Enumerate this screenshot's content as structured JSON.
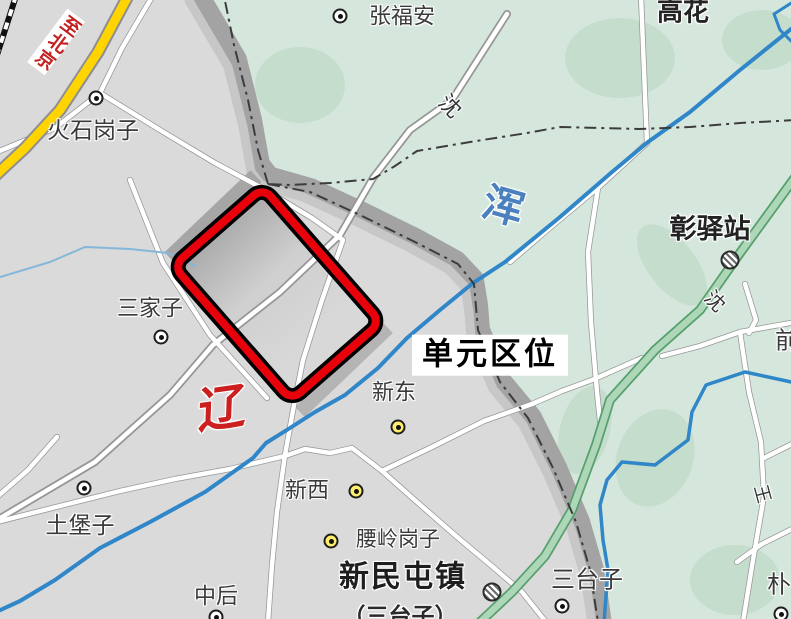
{
  "map": {
    "annotation": "单元区位",
    "colors": {
      "land": "#dadada",
      "green_area": "#d5e7dc",
      "green_patch": "#c5ddcd",
      "urban_band": "#a3a3a3",
      "urban_band_inner": "#c7c7c7",
      "water": "#2f86c8",
      "stream": "#85b7d9",
      "road_fill": "#ffffff",
      "road_casing": "#969696",
      "yellow_road": "#ffd400",
      "green_road": "#aed7ba",
      "green_road_casing": "#57a06c",
      "highlight_box": "#e8000b",
      "boundary_line": "#3c3c3c",
      "red_text": "#c32222",
      "river_text": "#4b80bf"
    },
    "labels": [
      {
        "name": "label-to-beijing",
        "text": "至北京",
        "x": 56,
        "y": 42,
        "size": 19,
        "weight": 700,
        "color": "#c32222",
        "rotate": 37,
        "bg": "#ffffff",
        "vertical": true,
        "pad": "2px 1px"
      },
      {
        "name": "label-huoshigangzi",
        "text": "火石岗子",
        "x": 93,
        "y": 130,
        "size": 23,
        "weight": 400,
        "color": "#3a3a3a",
        "rotate": 0
      },
      {
        "name": "label-zhangfuan",
        "text": "张福安",
        "x": 402,
        "y": 16,
        "size": 22,
        "weight": 400,
        "color": "#3a3a3a",
        "rotate": 0
      },
      {
        "name": "label-gaohua",
        "text": "高花",
        "x": 683,
        "y": 12,
        "size": 26,
        "weight": 700,
        "color": "#242424",
        "rotate": 0
      },
      {
        "name": "label-shen-road-north",
        "text": "沈",
        "x": 450,
        "y": 106,
        "size": 22,
        "weight": 400,
        "color": "#333333",
        "rotate": 45
      },
      {
        "name": "label-hun-river",
        "text": "浑",
        "x": 503,
        "y": 207,
        "size": 41,
        "weight": 700,
        "color": "#4b80bf",
        "rotate": 16
      },
      {
        "name": "label-zhangyizhan",
        "text": "彰驿站",
        "x": 710,
        "y": 229,
        "size": 27,
        "weight": 700,
        "color": "#222222",
        "rotate": 0
      },
      {
        "name": "label-sanjiazi",
        "text": "三家子",
        "x": 150,
        "y": 308,
        "size": 22,
        "weight": 400,
        "color": "#3a3a3a",
        "rotate": 0
      },
      {
        "name": "label-unit-location",
        "text": "单元区位",
        "x": 490,
        "y": 355,
        "size": 31,
        "weight": 700,
        "color": "#000000",
        "rotate": 0,
        "bg": "#ffffff",
        "pad": "4px 10px",
        "ls": 3
      },
      {
        "name": "label-liao-river",
        "text": "辽",
        "x": 222,
        "y": 410,
        "size": 48,
        "weight": 700,
        "color": "#cc1f1f",
        "rotate": -8,
        "skew": -10
      },
      {
        "name": "label-xindong",
        "text": "新东",
        "x": 394,
        "y": 392,
        "size": 22,
        "weight": 400,
        "color": "#3a3a3a",
        "rotate": 0
      },
      {
        "name": "label-xinxi",
        "text": "新西",
        "x": 307,
        "y": 490,
        "size": 22,
        "weight": 400,
        "color": "#3a3a3a",
        "rotate": 0
      },
      {
        "name": "label-yaolinggangzi",
        "text": "腰岭岗子",
        "x": 398,
        "y": 540,
        "size": 21,
        "weight": 400,
        "color": "#3a3a3a",
        "rotate": 0
      },
      {
        "name": "label-xinmintunzhen",
        "text": "新民屯镇",
        "x": 403,
        "y": 577,
        "size": 30,
        "weight": 700,
        "color": "#1e1e1e",
        "rotate": 0,
        "ls": 2
      },
      {
        "name": "label-santaizi-paren",
        "text": "（三台子）",
        "x": 400,
        "y": 616,
        "size": 23,
        "weight": 700,
        "color": "#2a2a2a",
        "rotate": 0
      },
      {
        "name": "label-zhonghou",
        "text": "中后",
        "x": 216,
        "y": 596,
        "size": 22,
        "weight": 400,
        "color": "#3a3a3a",
        "rotate": 0
      },
      {
        "name": "label-tubaozi",
        "text": "土堡子",
        "x": 80,
        "y": 525,
        "size": 23,
        "weight": 400,
        "color": "#3a3a3a",
        "rotate": 0
      },
      {
        "name": "label-santaizi",
        "text": "三台子",
        "x": 587,
        "y": 580,
        "size": 24,
        "weight": 400,
        "color": "#3a3a3a",
        "rotate": 0
      },
      {
        "name": "label-pu",
        "text": "朴",
        "x": 779,
        "y": 585,
        "size": 24,
        "weight": 400,
        "color": "#3a3a3a",
        "rotate": 0
      },
      {
        "name": "label-qian",
        "text": "前",
        "x": 787,
        "y": 341,
        "size": 24,
        "weight": 400,
        "color": "#3a3a3a",
        "rotate": 0
      },
      {
        "name": "label-shen-road-east",
        "text": "沈",
        "x": 714,
        "y": 302,
        "size": 20,
        "weight": 400,
        "color": "#333333",
        "rotate": 45
      },
      {
        "name": "label-wang-road",
        "text": "王",
        "x": 762,
        "y": 494,
        "size": 18,
        "weight": 400,
        "color": "#333333",
        "rotate": 75
      }
    ],
    "symbols": [
      {
        "name": "town-symbol-huoshigangzi",
        "type": "town",
        "x": 96,
        "y": 98
      },
      {
        "name": "town-symbol-zhangfuan",
        "type": "town",
        "x": 340,
        "y": 16
      },
      {
        "name": "town-symbol-sanjiazi",
        "type": "town",
        "x": 161,
        "y": 337
      },
      {
        "name": "town-symbol-tubaozi",
        "type": "town",
        "x": 84,
        "y": 488
      },
      {
        "name": "town-symbol-santaizi",
        "type": "town",
        "x": 562,
        "y": 606
      },
      {
        "name": "town-symbol-zhonghou",
        "type": "town",
        "x": 216,
        "y": 617
      },
      {
        "name": "town-symbol-pu",
        "type": "town",
        "x": 781,
        "y": 614
      },
      {
        "name": "town-symbol-xindong",
        "type": "town-yellow",
        "x": 398,
        "y": 427
      },
      {
        "name": "town-symbol-xinxi",
        "type": "town-yellow",
        "x": 356,
        "y": 491
      },
      {
        "name": "town-symbol-yaolinggangzi",
        "type": "town-yellow",
        "x": 331,
        "y": 541
      },
      {
        "name": "station-symbol-zhangyizhan",
        "type": "station",
        "x": 730,
        "y": 260
      },
      {
        "name": "station-symbol-xinmintunzhen",
        "type": "station",
        "x": 492,
        "y": 592
      }
    ]
  }
}
